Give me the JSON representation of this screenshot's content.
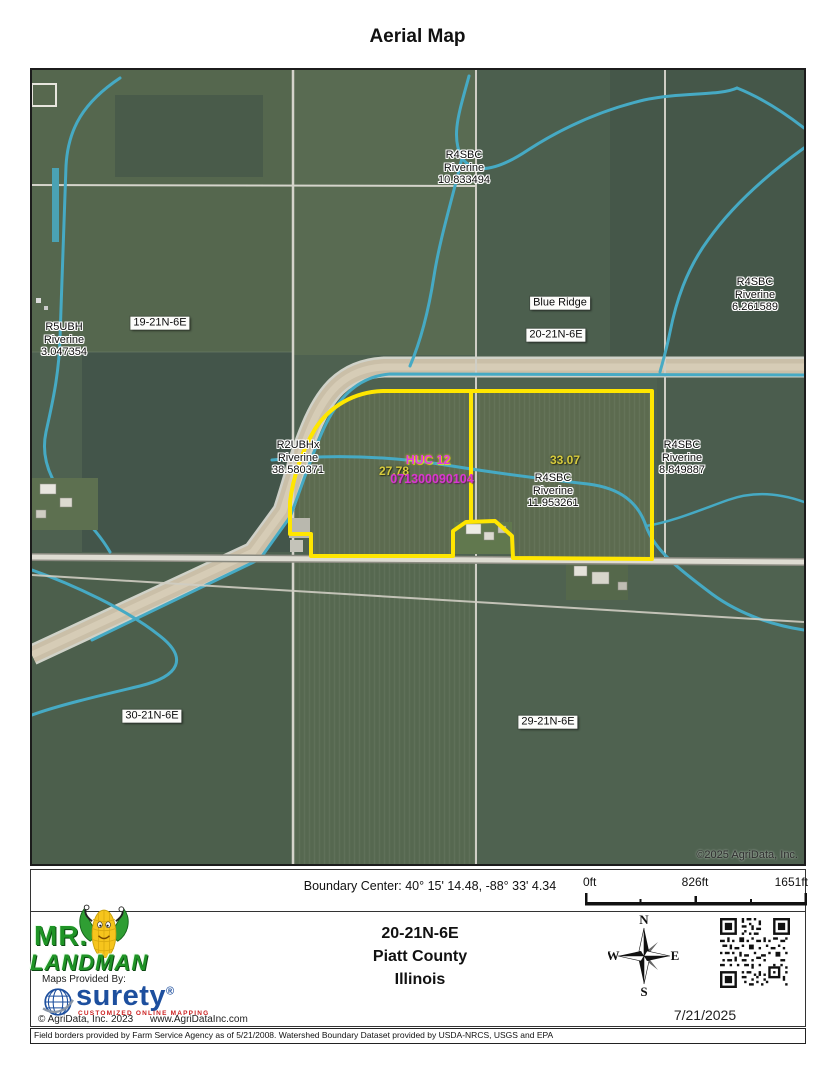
{
  "title": "Aerial Map",
  "map": {
    "copyright": "©2025 AgriData, Inc.",
    "labels": {
      "wetland_r4sbc_10": {
        "text": "R4SBC\nRiverine\n10.833494"
      },
      "wetland_r4sbc_6": {
        "text": "R4SBC\nRiverine\n6.261589"
      },
      "wetland_r5ubh_3": {
        "text": "R5UBH\nRiverine\n3.047354"
      },
      "wetland_r2ubhx_38": {
        "text": "R2UBHx\nRiverine\n38.580371"
      },
      "wetland_r4sbc_11": {
        "text": "R4SBC\nRiverine\n11.953261"
      },
      "wetland_r4sbc_8": {
        "text": "R4SBC\nRiverine\n8.849887"
      },
      "section_19": {
        "text": "19-21N-6E"
      },
      "section_20": {
        "text": "20-21N-6E"
      },
      "section_30": {
        "text": "30-21N-6E"
      },
      "section_29": {
        "text": "29-21N-6E"
      },
      "place_blue_ridge": {
        "text": "Blue Ridge"
      },
      "huc12_title": {
        "text": "HUC 12"
      },
      "huc12_code": {
        "text": "071300090104"
      },
      "acres_west": {
        "text": "27.78"
      },
      "acres_east": {
        "text": "33.07"
      }
    },
    "colors": {
      "parcel_boundary": "#ffe600",
      "stream": "#46aac4",
      "huc_label": "#e23ae2",
      "acres_label": "#d6ca3e"
    }
  },
  "footer": {
    "boundary_center": "Boundary Center: 40° 15' 14.48,  -88° 33' 4.34",
    "scale": {
      "start": "0ft",
      "mid": "826ft",
      "end": "1651ft"
    },
    "location": {
      "trs": "20-21N-6E",
      "county": "Piatt County",
      "state": "Illinois"
    },
    "compass": {
      "n": "N",
      "e": "E",
      "s": "S",
      "w": "W"
    },
    "date": "7/21/2025",
    "disclaimer": "Field borders provided by Farm Service Agency as of 5/21/2008. Watershed Boundary Dataset provided by USDA-NRCS, USGS and EPA",
    "logo": {
      "brand_top": "MR.",
      "brand_bottom": "LANDMAN",
      "maps_provided_by": "Maps Provided By:",
      "surety": "surety",
      "surety_reg": "®",
      "surety_tagline": "CUSTOMIZED ONLINE MAPPING",
      "surety_blue": "#1d4f9e",
      "agridata_copyright": "© AgriData, Inc. 2023",
      "agridata_url": "www.AgriDataInc.com"
    }
  }
}
